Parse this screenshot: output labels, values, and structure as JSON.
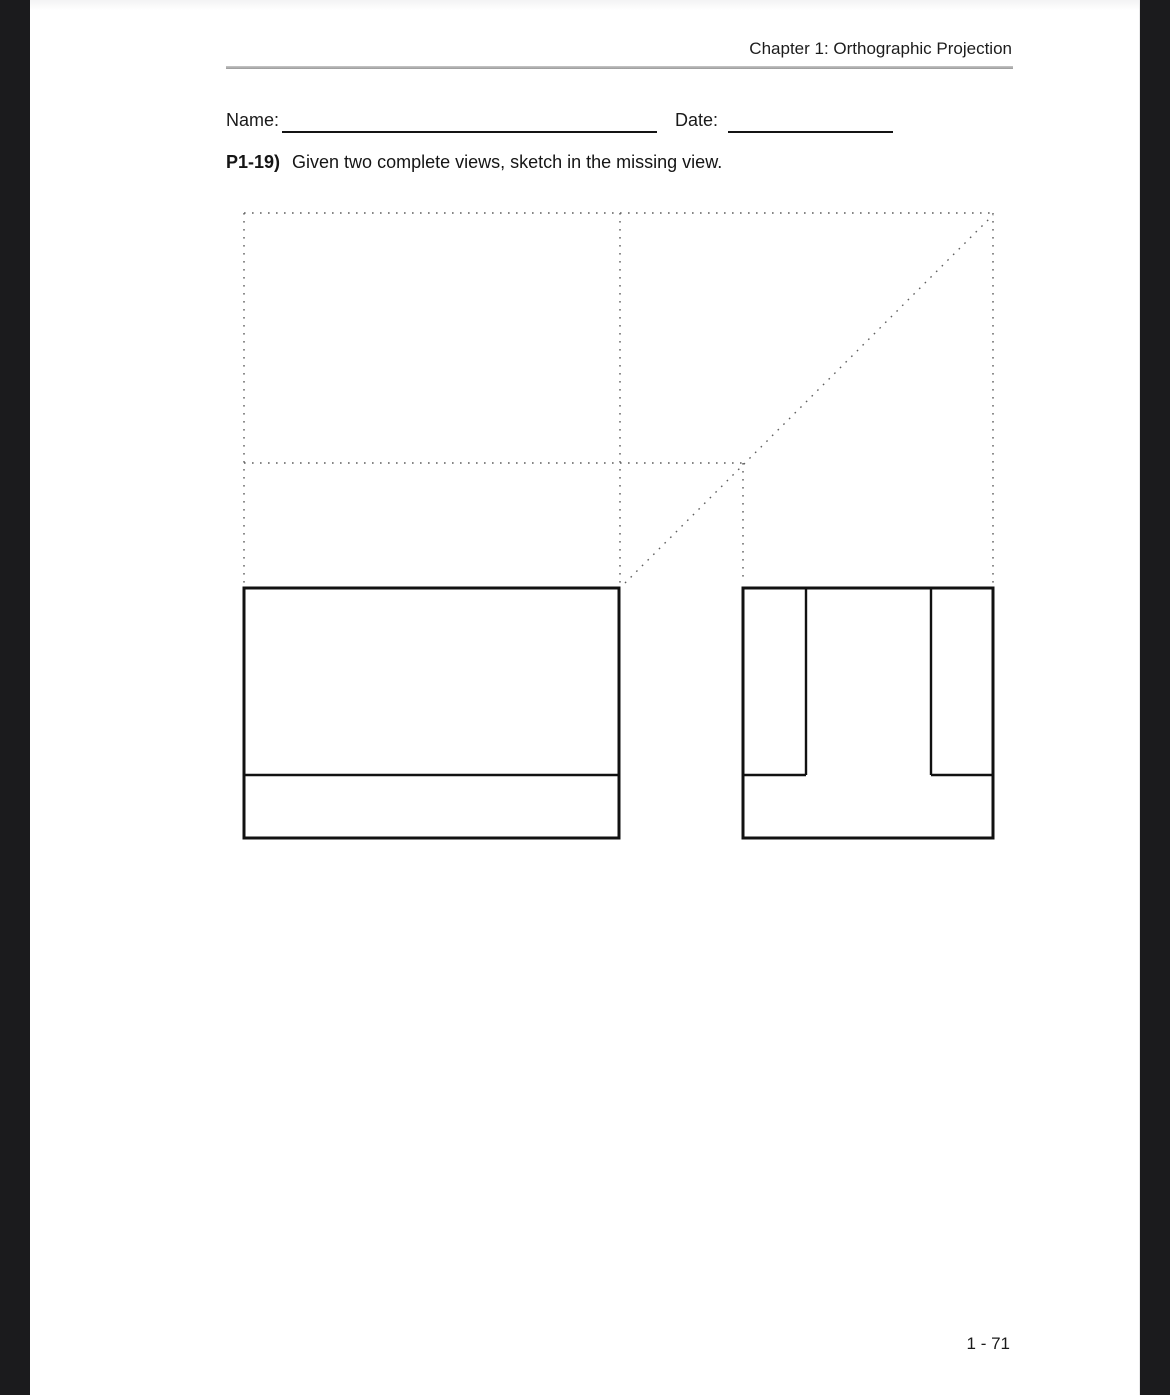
{
  "page": {
    "header": {
      "title": "Chapter 1: Orthographic Projection"
    },
    "form": {
      "name_label": "Name:",
      "date_label": "Date:"
    },
    "problem": {
      "number": "P1-19)",
      "instruction": "Given two complete views, sketch in the missing view."
    },
    "footer": {
      "page_number": "1 - 71"
    }
  },
  "drawing": {
    "description": "orthographic projection construction grid with front and side views",
    "dotted_color": "#5f5f5f",
    "solid_color": "#111111",
    "dotted_lines": [
      {
        "x1": 214,
        "y1": 213,
        "x2": 963,
        "y2": 213
      },
      {
        "x1": 214,
        "y1": 463,
        "x2": 713,
        "y2": 463
      },
      {
        "x1": 214,
        "y1": 213,
        "x2": 214,
        "y2": 583
      },
      {
        "x1": 590,
        "y1": 213,
        "x2": 590,
        "y2": 583
      },
      {
        "x1": 713,
        "y1": 463,
        "x2": 713,
        "y2": 583
      },
      {
        "x1": 963,
        "y1": 213,
        "x2": 963,
        "y2": 583
      },
      {
        "x1": 595,
        "y1": 583,
        "x2": 963,
        "y2": 215
      }
    ],
    "solid_rects": [
      {
        "x": 214,
        "y": 588,
        "w": 375,
        "h": 250
      },
      {
        "x": 713,
        "y": 588,
        "w": 250,
        "h": 250
      }
    ],
    "solid_lines": [
      {
        "x1": 214,
        "y1": 775,
        "x2": 589,
        "y2": 775
      },
      {
        "x1": 776,
        "y1": 588,
        "x2": 776,
        "y2": 775
      },
      {
        "x1": 901,
        "y1": 588,
        "x2": 901,
        "y2": 775
      },
      {
        "x1": 713,
        "y1": 775,
        "x2": 776,
        "y2": 775
      },
      {
        "x1": 901,
        "y1": 775,
        "x2": 963,
        "y2": 775
      }
    ]
  }
}
